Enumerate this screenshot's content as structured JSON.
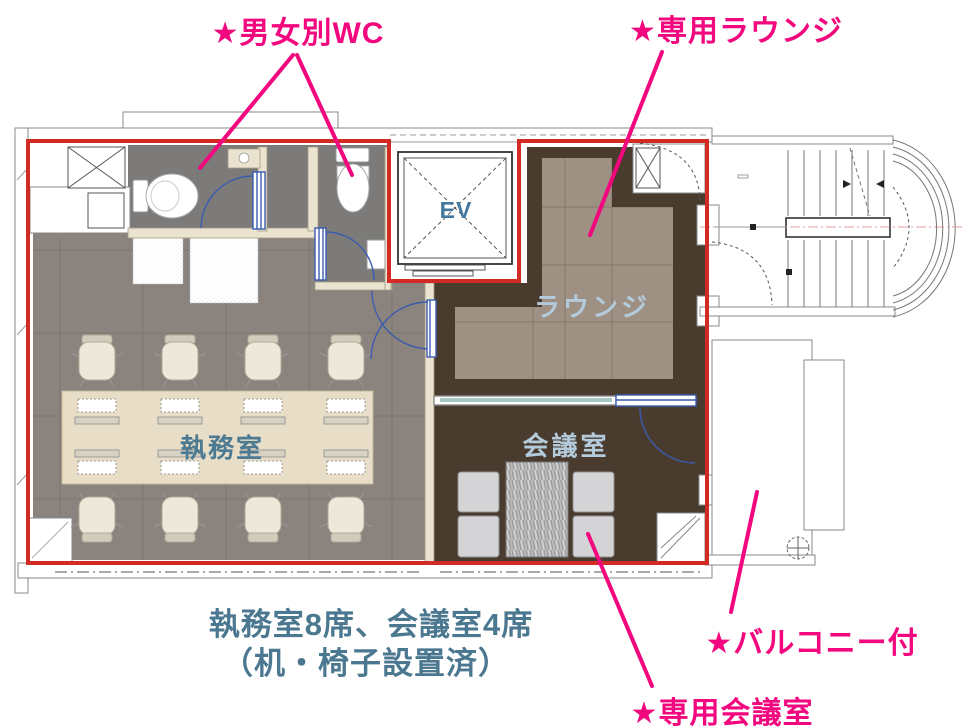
{
  "annotations": {
    "wc": "★男女別WC",
    "lounge": "★専用ラウンジ",
    "balcony": "★バルコニー付",
    "meeting_room": "★専用会議室"
  },
  "rooms": {
    "office": "執務室",
    "meeting": "会議室",
    "lounge": "ラウンジ",
    "elevator": "EV"
  },
  "caption": {
    "line1": "執務室8席、会議室4席",
    "line2": "（机・椅子設置済）"
  },
  "colors": {
    "annotation_pink": "#f2077e",
    "boundary_red": "#d22b25",
    "caption_teal": "#4b7890",
    "room_label_light": "#b3cbdb",
    "room_label_dark": "#4c7a92",
    "office_floor": "#8b837d",
    "wc_floor": "#7c7b79",
    "lounge_dark": "#4a3b2f",
    "lounge_taupe": "#9e9083",
    "desk_beige": "#e8ddc7",
    "door_blue": "#3a5cb0"
  }
}
